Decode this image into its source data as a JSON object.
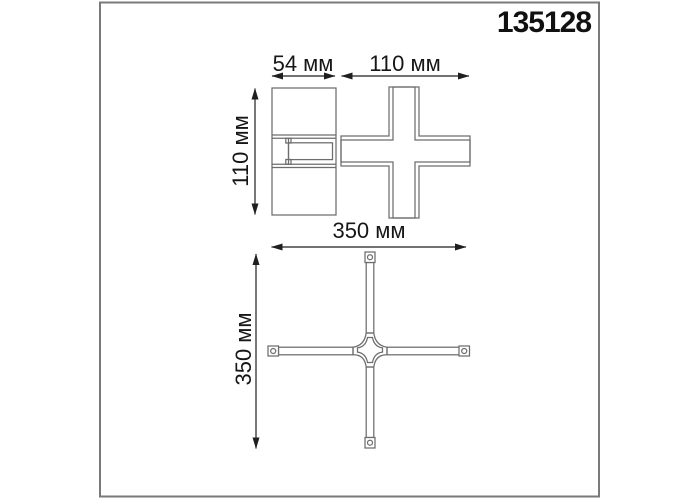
{
  "drawing": {
    "article": "135128",
    "dimensions": {
      "side_width_label": "54 мм",
      "top_view_width_label": "110 мм",
      "side_height_label": "110 мм",
      "overall_width_label": "350 мм",
      "overall_height_label": "350 мм"
    },
    "colors": {
      "background": "#ffffff",
      "frame_border": "#7a7a7a",
      "drawing_line": "#6d6d6d",
      "dimension_line": "#1f1f1f",
      "text": "#111111"
    }
  }
}
